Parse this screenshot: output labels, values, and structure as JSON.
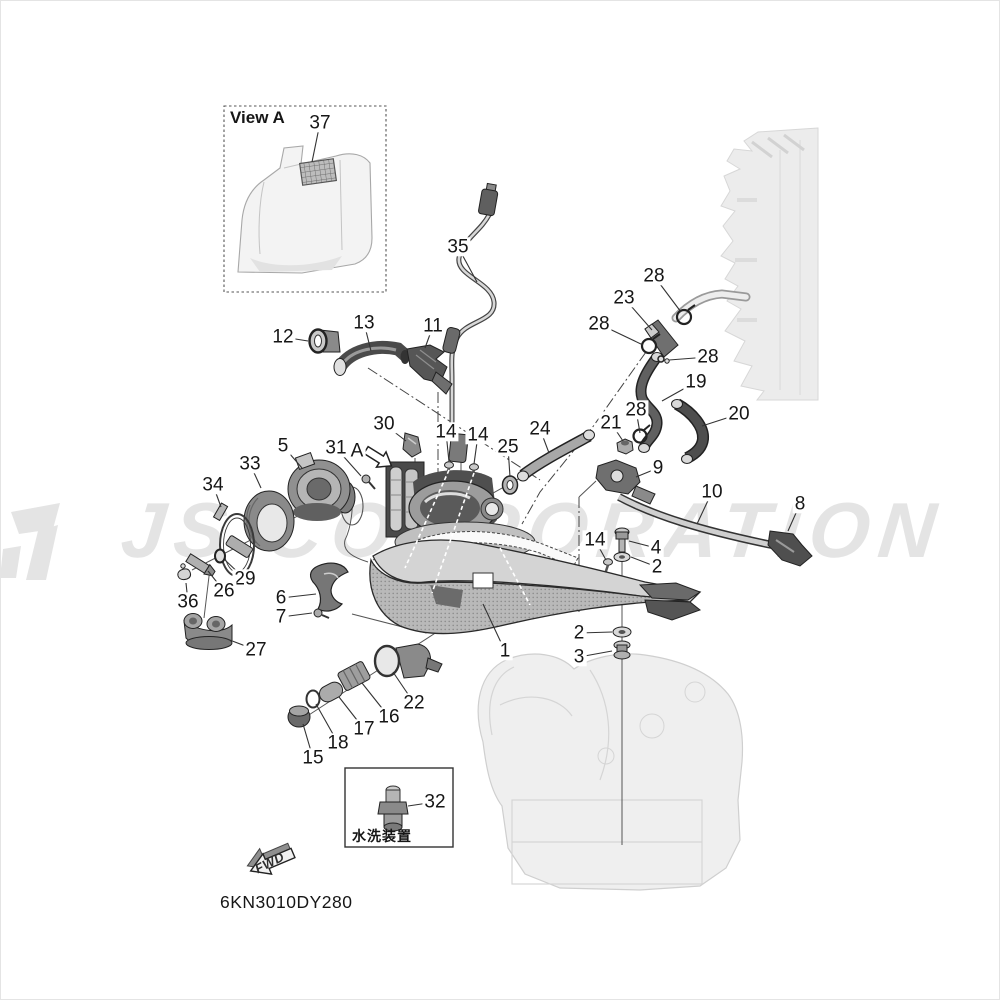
{
  "watermark": {
    "text": "JS CORPORATION"
  },
  "view_a": {
    "title": "View A"
  },
  "inset": {
    "caption": "水洗装置"
  },
  "fwd_label": "FWD",
  "drawing_code": "6KN3010DY280",
  "callouts": [
    {
      "t": "37",
      "x": 320,
      "y": 123,
      "lx": 312,
      "ly": 162
    },
    {
      "t": "35",
      "x": 458,
      "y": 247,
      "lx": 477,
      "ly": 282
    },
    {
      "t": "12",
      "x": 283,
      "y": 337,
      "lx": 308,
      "ly": 341
    },
    {
      "t": "13",
      "x": 364,
      "y": 323,
      "lx": 371,
      "ly": 351
    },
    {
      "t": "11",
      "x": 433,
      "y": 326,
      "lx": 425,
      "ly": 348
    },
    {
      "t": "28",
      "x": 654,
      "y": 276,
      "lx": 681,
      "ly": 312
    },
    {
      "t": "23",
      "x": 624,
      "y": 298,
      "lx": 652,
      "ly": 330
    },
    {
      "t": "28",
      "x": 599,
      "y": 324,
      "lx": 643,
      "ly": 345
    },
    {
      "t": "28",
      "x": 708,
      "y": 357,
      "lx": 669,
      "ly": 360
    },
    {
      "t": "19",
      "x": 696,
      "y": 382,
      "lx": 662,
      "ly": 401
    },
    {
      "t": "20",
      "x": 739,
      "y": 414,
      "lx": 702,
      "ly": 426
    },
    {
      "t": "28",
      "x": 636,
      "y": 410,
      "lx": 640,
      "ly": 433
    },
    {
      "t": "21",
      "x": 611,
      "y": 423,
      "lx": 623,
      "ly": 441
    },
    {
      "t": "30",
      "x": 384,
      "y": 424,
      "lx": 406,
      "ly": 441
    },
    {
      "t": "14",
      "x": 446,
      "y": 432,
      "lx": 449,
      "ly": 462
    },
    {
      "t": "14",
      "x": 478,
      "y": 435,
      "lx": 474,
      "ly": 464
    },
    {
      "t": "25",
      "x": 508,
      "y": 447,
      "lx": 510,
      "ly": 477
    },
    {
      "t": "24",
      "x": 540,
      "y": 429,
      "lx": 549,
      "ly": 453
    },
    {
      "t": "5",
      "x": 283,
      "y": 446,
      "lx": 302,
      "ly": 468
    },
    {
      "t": "31",
      "x": 336,
      "y": 448,
      "lx": 361,
      "ly": 476
    },
    {
      "t": "A",
      "x": 357,
      "y": 451,
      "lx": null,
      "ly": null
    },
    {
      "t": "33",
      "x": 250,
      "y": 464,
      "lx": 261,
      "ly": 488
    },
    {
      "t": "9",
      "x": 658,
      "y": 468,
      "lx": 636,
      "ly": 477
    },
    {
      "t": "34",
      "x": 213,
      "y": 485,
      "lx": 221,
      "ly": 507
    },
    {
      "t": "10",
      "x": 712,
      "y": 492,
      "lx": 697,
      "ly": 524
    },
    {
      "t": "8",
      "x": 800,
      "y": 504,
      "lx": 788,
      "ly": 531
    },
    {
      "t": "14",
      "x": 595,
      "y": 540,
      "lx": 606,
      "ly": 560
    },
    {
      "t": "4",
      "x": 656,
      "y": 548,
      "lx": 629,
      "ly": 541
    },
    {
      "t": "2",
      "x": 657,
      "y": 567,
      "lx": 631,
      "ly": 557
    },
    {
      "t": "29",
      "x": 245,
      "y": 579,
      "lx": 225,
      "ly": 560
    },
    {
      "t": "26",
      "x": 224,
      "y": 591,
      "lx": 208,
      "ly": 571
    },
    {
      "t": "36",
      "x": 188,
      "y": 602,
      "lx": 186,
      "ly": 583
    },
    {
      "t": "6",
      "x": 281,
      "y": 598,
      "lx": 316,
      "ly": 594
    },
    {
      "t": "7",
      "x": 281,
      "y": 617,
      "lx": 312,
      "ly": 613
    },
    {
      "t": "27",
      "x": 256,
      "y": 650,
      "lx": 227,
      "ly": 639
    },
    {
      "t": "1",
      "x": 505,
      "y": 651,
      "lx": 483,
      "ly": 604
    },
    {
      "t": "2",
      "x": 579,
      "y": 633,
      "lx": 612,
      "ly": 632
    },
    {
      "t": "3",
      "x": 579,
      "y": 657,
      "lx": 612,
      "ly": 651
    },
    {
      "t": "22",
      "x": 414,
      "y": 703,
      "lx": 393,
      "ly": 672
    },
    {
      "t": "16",
      "x": 389,
      "y": 717,
      "lx": 362,
      "ly": 683
    },
    {
      "t": "17",
      "x": 364,
      "y": 729,
      "lx": 339,
      "ly": 697
    },
    {
      "t": "18",
      "x": 338,
      "y": 743,
      "lx": 316,
      "ly": 704
    },
    {
      "t": "15",
      "x": 313,
      "y": 758,
      "lx": 303,
      "ly": 724
    },
    {
      "t": "32",
      "x": 435,
      "y": 802,
      "lx": 408,
      "ly": 806
    }
  ]
}
